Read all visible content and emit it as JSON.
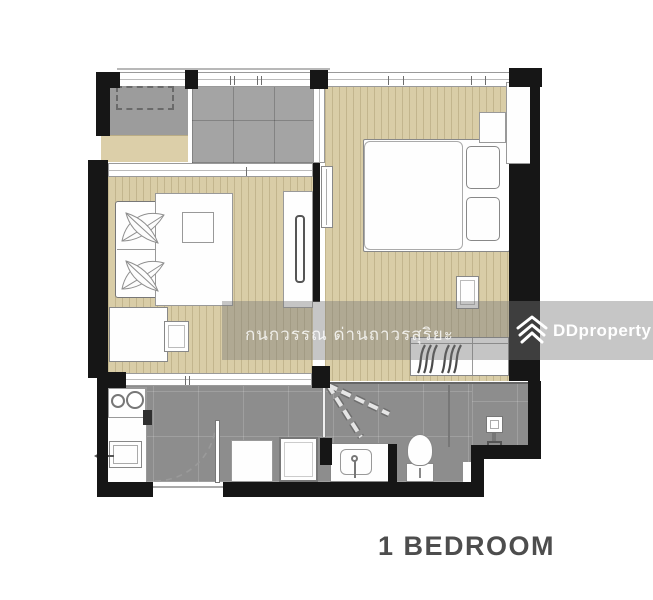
{
  "title": {
    "label": "1 BEDROOM"
  },
  "watermark": {
    "owner_text": "กนกวรรณ ด่านถาวรสุริยะ",
    "brand": "DDproperty",
    "logo_icon": "ddproperty-chevrons-icon"
  },
  "palette": {
    "wall": "#161616",
    "wood_floor": "#d9cda7",
    "tile_floor": "#8d8d8d",
    "balcony_floor": "#a4a4a4",
    "ac_ledge_floor": "#9c9c9c",
    "planter_ledge": "#dccfa9",
    "furniture_fill": "#fefefe",
    "furniture_outline": "#8a8a8a",
    "watermark_band": "rgba(118,118,118,0.42)",
    "watermark_text": "rgba(255,255,255,0.8)",
    "title_text": "#4d4d4d"
  }
}
